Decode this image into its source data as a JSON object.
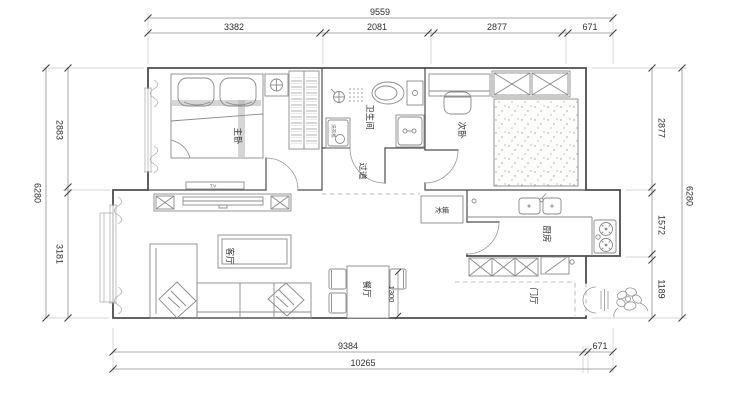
{
  "plan": {
    "rooms": {
      "master_bedroom": "主卧",
      "bathroom": "卫生间",
      "second_bedroom": "次卧",
      "hallway": "过道",
      "living_room": "客厅",
      "dining_room": "餐厅",
      "kitchen": "厨房",
      "entry": "门厅"
    },
    "labels": {
      "fridge": "冰箱",
      "washing_machine": "洗衣机",
      "tv_bench": "T.V"
    }
  },
  "dimensions": {
    "top": {
      "overall": "9559",
      "seg1": "3382",
      "seg2": "2081",
      "seg3": "2877",
      "seg4": "671"
    },
    "bottom": {
      "inner": "9384",
      "inner_right": "671",
      "overall": "10265"
    },
    "left": {
      "overall": "6280",
      "upper": "2883",
      "lower": "3181"
    },
    "right": {
      "upper": "2877",
      "middle": "1572",
      "lower": "1189",
      "overall": "6280"
    },
    "dining_table": "1300"
  },
  "colors": {
    "background": "#ffffff",
    "wall": "#4d4d4d",
    "furniture": "#8a8a8a",
    "dimension_line": "#8c8c8c",
    "text": "#2f2f2f"
  }
}
